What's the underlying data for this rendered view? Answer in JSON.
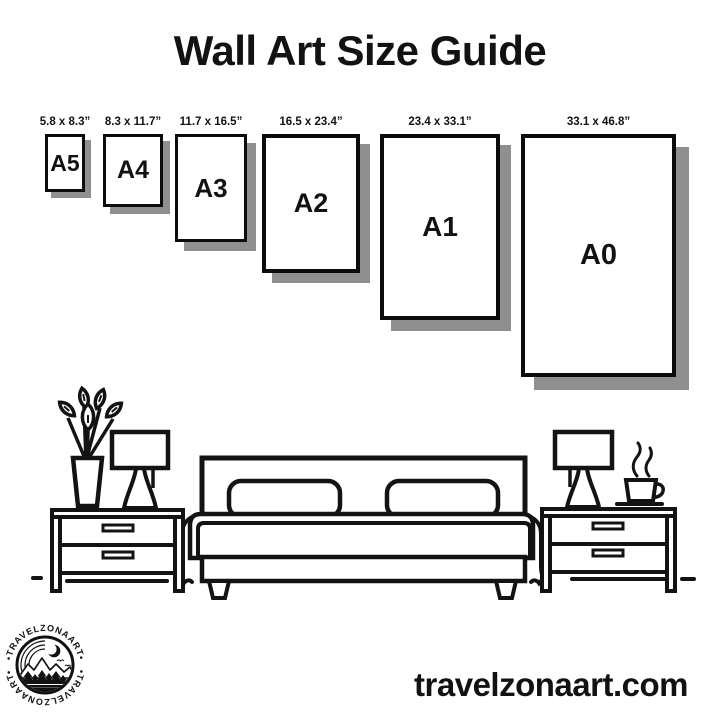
{
  "page": {
    "title": "Wall Art Size Guide",
    "website": "travelzonaart.com",
    "background_color": "#ffffff",
    "ink_color": "#131313",
    "shadow_color": "#8f8f8f"
  },
  "size_guide": {
    "items": [
      {
        "name": "A5",
        "dimensions": "5.8 x 8.3”"
      },
      {
        "name": "A4",
        "dimensions": "8.3 x 11.7”"
      },
      {
        "name": "A3",
        "dimensions": "11.7 x 16.5”"
      },
      {
        "name": "A2",
        "dimensions": "16.5 x 23.4”"
      },
      {
        "name": "A1",
        "dimensions": "23.4 x 33.1”"
      },
      {
        "name": "A0",
        "dimensions": "33.1 x 46.8”"
      }
    ]
  },
  "logo": {
    "arc_text_top": "•TRAVELZONAART•",
    "arc_text_bottom": "•TRAVELZONAART•",
    "icons": [
      "crescent-moon-icon",
      "mountains-icon",
      "pine-trees-icon",
      "water-lines-icon",
      "birds-icon"
    ]
  },
  "illustration": {
    "icons": [
      "plant-vase-icon",
      "table-lamp-icon",
      "nightstand-icon",
      "bed-icon",
      "coffee-cup-icon",
      "floor-line"
    ]
  }
}
